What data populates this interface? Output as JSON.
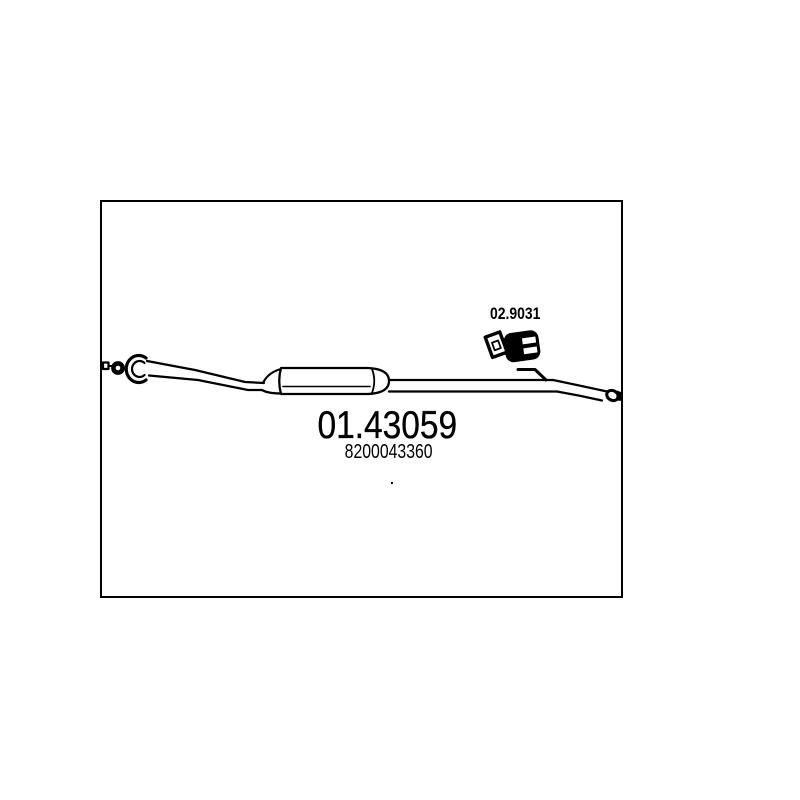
{
  "frame": {
    "background": "#ffffff",
    "border_color": "#000000"
  },
  "labels": {
    "main_code": "01.43059",
    "oe_number": "8200043360",
    "clamp_code": "02.9031",
    "stray_dot": "."
  },
  "drawing": {
    "line_color": "#000000",
    "fill_color": "#ffffff",
    "icon_names": [
      "inlet-mount-square-icon",
      "inlet-ring-icon",
      "inlet-flange-icon",
      "front-pipe",
      "center-silencer-body",
      "rear-pipe",
      "pipe-hook-icon",
      "rubber-hanger-icon",
      "hanger-bracket-icon",
      "tail-pipe",
      "tail-end-cap-icon"
    ]
  }
}
